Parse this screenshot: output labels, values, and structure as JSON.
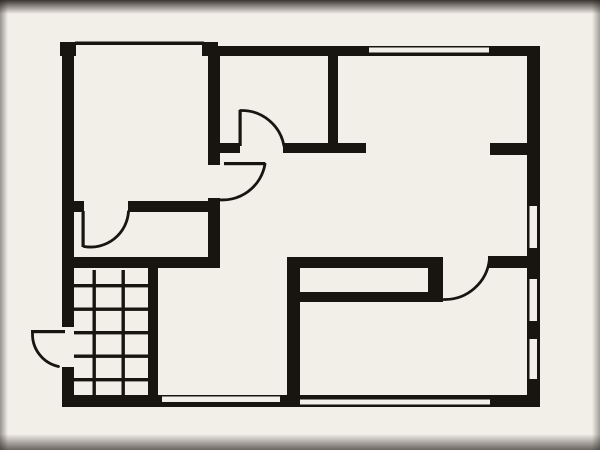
{
  "title": "house-floor-plan",
  "colors": {
    "background": "#e7e1da",
    "paper": "#f2eee8",
    "ink": "#181410"
  },
  "plan": {
    "width": 600,
    "height": 450,
    "walls": [
      {
        "name": "outer-wall-top-left-corner-block",
        "x": 60,
        "y": 42,
        "w": 16,
        "h": 14
      },
      {
        "name": "outer-wall-left-upper",
        "x": 62,
        "y": 42,
        "w": 12,
        "h": 285
      },
      {
        "name": "outer-wall-left-lower",
        "x": 62,
        "y": 367,
        "w": 12,
        "h": 40
      },
      {
        "name": "outer-wall-bottom",
        "x": 62,
        "y": 395,
        "w": 478,
        "h": 12
      },
      {
        "name": "outer-wall-top",
        "x": 202,
        "y": 46,
        "w": 338,
        "h": 10
      },
      {
        "name": "outer-wall-top-window-end-block",
        "x": 202,
        "y": 42,
        "w": 16,
        "h": 6
      },
      {
        "name": "outer-wall-right",
        "x": 527,
        "y": 46,
        "w": 13,
        "h": 361
      },
      {
        "name": "bedroom-right-wall-upper",
        "x": 208,
        "y": 52,
        "w": 12,
        "h": 113
      },
      {
        "name": "bedroom-right-wall-lower",
        "x": 208,
        "y": 198,
        "w": 12,
        "h": 70
      },
      {
        "name": "bedroom-bottom-wall-stub",
        "x": 74,
        "y": 201,
        "w": 10,
        "h": 11
      },
      {
        "name": "bedroom-bottom-wall",
        "x": 128,
        "y": 201,
        "w": 92,
        "h": 11
      },
      {
        "name": "landing-bottom-wall",
        "x": 74,
        "y": 257,
        "w": 146,
        "h": 11
      },
      {
        "name": "stair-right-wall",
        "x": 148,
        "y": 268,
        "w": 10,
        "h": 127
      },
      {
        "name": "bathroom-right-wall",
        "x": 328,
        "y": 56,
        "w": 10,
        "h": 91
      },
      {
        "name": "hall-top-wall-left-segment",
        "x": 220,
        "y": 143,
        "w": 20,
        "h": 10
      },
      {
        "name": "hall-top-wall-right-segment",
        "x": 283,
        "y": 143,
        "w": 83,
        "h": 10
      },
      {
        "name": "top-right-room-bottom-stub",
        "x": 490,
        "y": 143,
        "w": 37,
        "h": 12
      },
      {
        "name": "kitchen-left-wall",
        "x": 287,
        "y": 258,
        "w": 13,
        "h": 137
      },
      {
        "name": "kitchen-counter-top-band",
        "x": 287,
        "y": 257,
        "w": 156,
        "h": 11
      },
      {
        "name": "kitchen-counter-bottom-band",
        "x": 300,
        "y": 292,
        "w": 143,
        "h": 10
      },
      {
        "name": "kitchen-counter-right-connector",
        "x": 428,
        "y": 268,
        "w": 15,
        "h": 24
      },
      {
        "name": "kitchen-top-wall-right-stub",
        "x": 488,
        "y": 256,
        "w": 39,
        "h": 12
      }
    ],
    "window_slots": [
      {
        "name": "window-top-right",
        "x": 369,
        "y": 47.5,
        "w": 120,
        "h": 5
      },
      {
        "name": "window-right-upper",
        "x": 529.5,
        "y": 206,
        "w": 7.5,
        "h": 42
      },
      {
        "name": "window-right-middle",
        "x": 529.5,
        "y": 279,
        "w": 7.5,
        "h": 42
      },
      {
        "name": "window-right-lower",
        "x": 529.5,
        "y": 339,
        "w": 7.5,
        "h": 40
      },
      {
        "name": "window-bottom-left",
        "x": 162,
        "y": 396.5,
        "w": 118,
        "h": 5.5
      },
      {
        "name": "window-bottom-right",
        "x": 300,
        "y": 399.5,
        "w": 190,
        "h": 5
      }
    ],
    "window_lines": [
      {
        "name": "window-top-left-line",
        "x": 75,
        "y": 41.5,
        "w": 129,
        "h": 3.5
      }
    ],
    "stairs": {
      "name": "staircase",
      "x": 74,
      "y": 270,
      "w": 74,
      "h": 125,
      "v_lines": [
        92.5,
        121.5
      ],
      "h_lines": [
        284,
        307.5,
        331,
        354.5,
        378
      ],
      "line_thickness": 3.4
    },
    "doors": [
      {
        "name": "door-bathroom",
        "leaf": {
          "x": 238.5,
          "y": 110,
          "w": 3.2,
          "h": 36
        },
        "arc": "M 240.5 110.5 A 43 43 0 0 1 284 146"
      },
      {
        "name": "door-bedroom-to-hall",
        "leaf": {
          "x": 224,
          "y": 162,
          "w": 41,
          "h": 3.2
        },
        "arc": "M 265 164 A 43 43 0 0 1 216.5 199.5"
      },
      {
        "name": "door-bedroom-to-landing",
        "leaf": {
          "x": 81.5,
          "y": 211,
          "w": 3.2,
          "h": 36
        },
        "arc": "M 84 246.5 A 38 38 0 0 0 128.5 211.5"
      },
      {
        "name": "door-kitchen",
        "leaf": null,
        "arc": "M 489.5 259 A 45 45 0 0 1 444 299.5"
      },
      {
        "name": "door-entrance-exterior",
        "leaf": {
          "x": 31,
          "y": 330,
          "w": 34,
          "h": 3.2
        },
        "arc": "M 32.5 333.5 A 33 33 0 0 0 58.5 366.5"
      }
    ]
  }
}
